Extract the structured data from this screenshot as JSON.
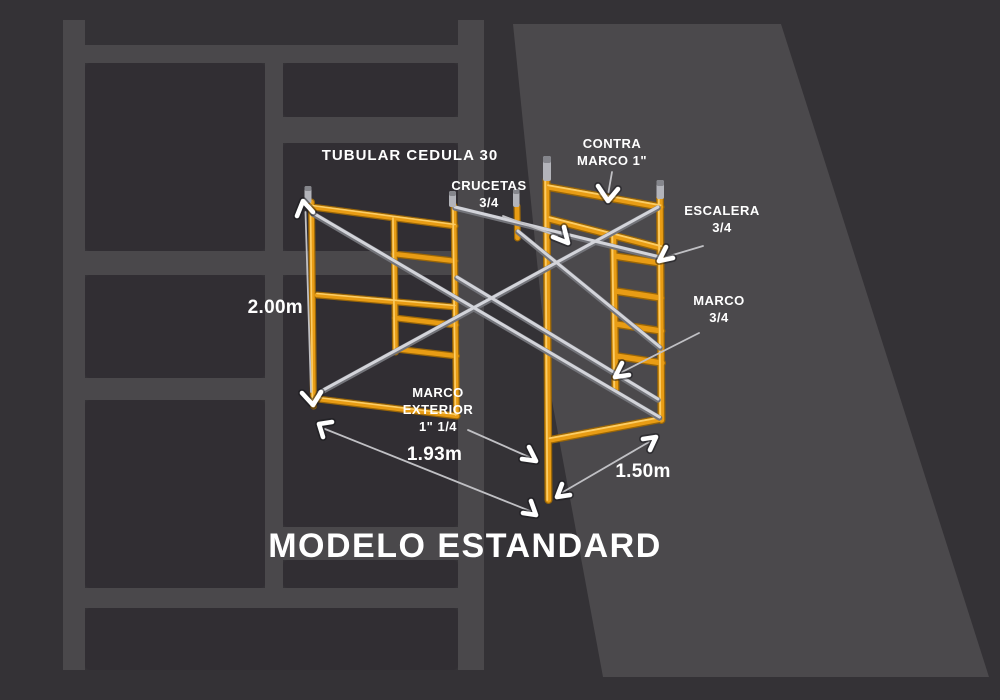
{
  "title": "MODELO ESTANDARD",
  "heading": "TUBULAR CEDULA 30",
  "labels": {
    "crucetas": [
      "CRUCETAS",
      "3/4"
    ],
    "contra_marco": [
      "CONTRA",
      "MARCO 1\""
    ],
    "escalera": [
      "ESCALERA",
      "3/4"
    ],
    "marco": [
      "MARCO",
      "3/4"
    ],
    "marco_exterior": [
      "MARCO",
      "EXTERIOR",
      "1\" 1/4"
    ]
  },
  "dimensions": {
    "height": "2.00m",
    "depth": "1.93m",
    "width": "1.50m"
  },
  "colors": {
    "background": "#343236",
    "watermark_bar": "#4a484b",
    "watermark_panel": "#312e33",
    "watermark_wedge": "#4b494c",
    "tube_orange": "#e89c14",
    "tube_highlight": "#ffd36e",
    "tube_shadow": "#9a6607",
    "brace_silver": "#d3d4da",
    "pin_silver": "#b3b4ba",
    "text": "#ffffff"
  }
}
